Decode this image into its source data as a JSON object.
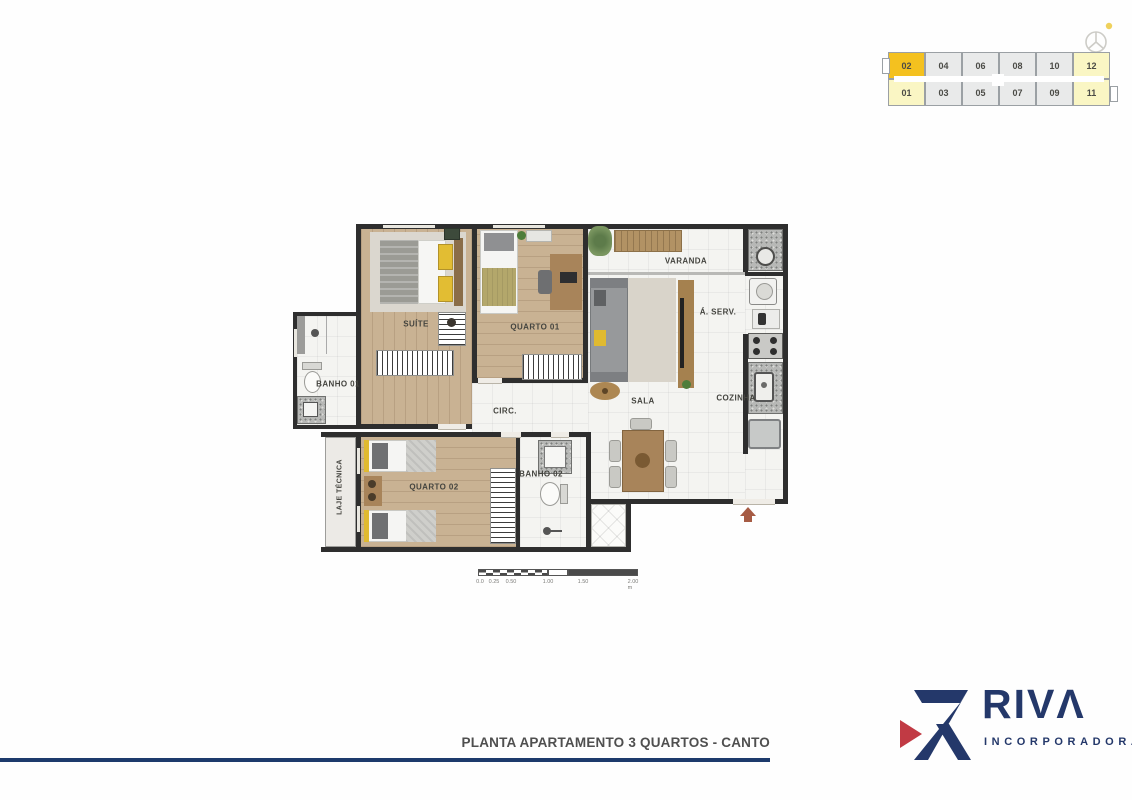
{
  "keymap": {
    "top_row": [
      "02",
      "04",
      "06",
      "08",
      "10",
      "12"
    ],
    "bottom_row": [
      "01",
      "03",
      "05",
      "07",
      "09",
      "11"
    ],
    "highlighted_unit": "02",
    "colors": {
      "highlight": "#F4C11F",
      "corner_units": "#FAF6C4",
      "default": "#E9EAEA"
    }
  },
  "plan": {
    "rooms": {
      "suite": "SUÍTE",
      "quarto01": "QUARTO 01",
      "varanda": "VARANDA",
      "aserv": "Á. SERV.",
      "banho01": "BANHO 01",
      "circ": "CIRC.",
      "sala": "SALA",
      "cozinha": "COZINHA",
      "quarto02": "QUARTO 02",
      "banho02": "BANHO 02",
      "laje": "LAJE TÉCNICA"
    },
    "scale_bar": {
      "ticks": [
        "0.0",
        "0.25",
        "0.50",
        "1.00",
        "1.50",
        "2.00 m"
      ]
    },
    "colors": {
      "wall": "#2e2e2e",
      "wood": "#c9b293",
      "tile": "#f4f4f1",
      "accent_yellow": "#e0ba30",
      "entry_arrow": "#a65b44"
    }
  },
  "footer": {
    "caption": "PLANTA APARTAMENTO 3 QUARTOS - CANTO",
    "line_color": "#1d3a6c"
  },
  "logo": {
    "brand": "RIVΛ",
    "subtitle": "INCORPORADORA",
    "navy": "#24386A",
    "red": "#C13A44"
  }
}
